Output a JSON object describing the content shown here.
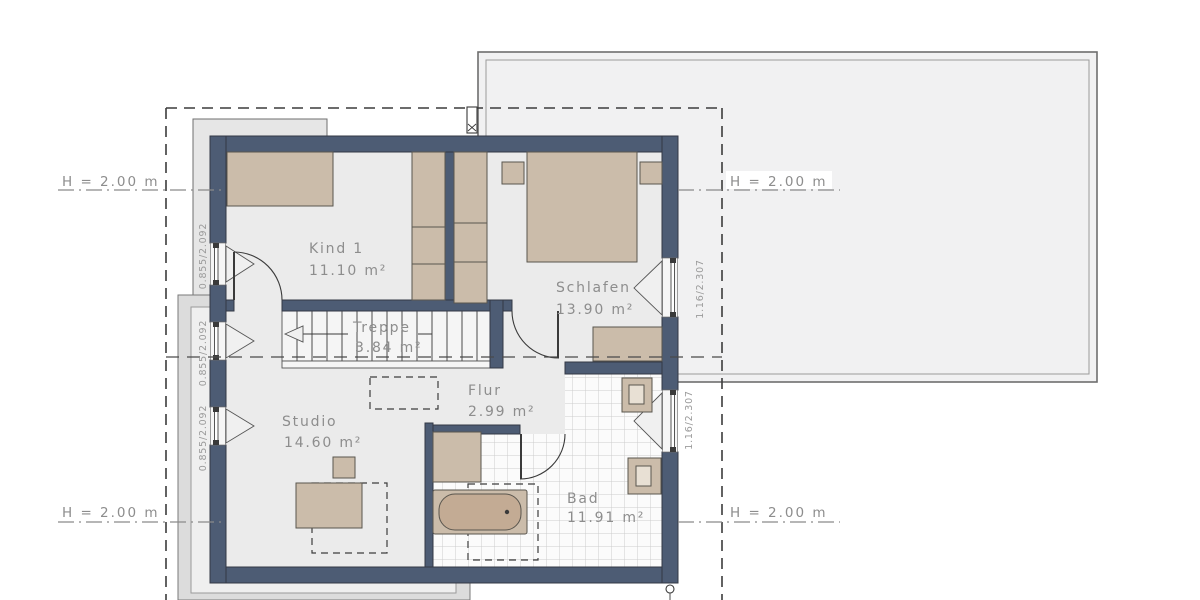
{
  "rooms": [
    {
      "id": "kind1",
      "name": "Kind 1",
      "area": "11.10 m²"
    },
    {
      "id": "schlafen",
      "name": "Schlafen",
      "area": "13.90 m²"
    },
    {
      "id": "treppe",
      "name": "Treppe",
      "area": "3.84 m²"
    },
    {
      "id": "flur",
      "name": "Flur",
      "area": "2.99 m²"
    },
    {
      "id": "studio",
      "name": "Studio",
      "area": "14.60 m²"
    },
    {
      "id": "bad",
      "name": "Bad",
      "area": "11.91 m²"
    }
  ],
  "annotations": {
    "height_label": "H = 2.00 m",
    "window_small": "0.855/2.092",
    "window_large": "1.16/2.307"
  },
  "colors": {
    "wall": "#4d5c74",
    "floor": "#ebebeb",
    "furniture": "#cbbcaa",
    "tub_inner": "#c3ab94",
    "tile_bg": "#fbfbfb",
    "tile_line": "#cdcdcd",
    "terrace": "#f1f1f2",
    "label_text": "#8d8d8d",
    "dim_text": "#9a9a9a"
  }
}
